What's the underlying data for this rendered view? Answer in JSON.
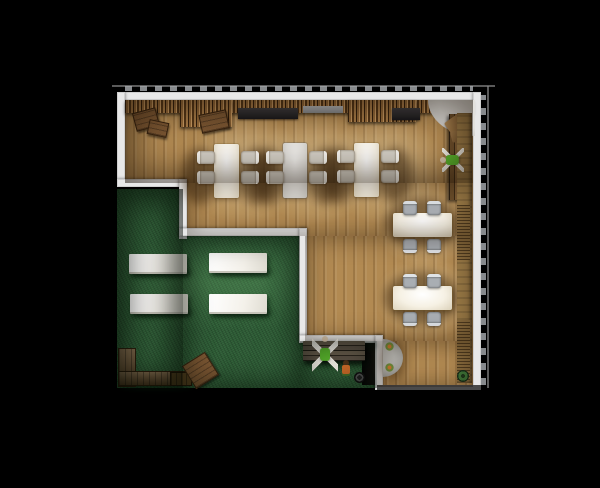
{
  "scene": {
    "title": "cafe-floor-plan-top-down-render",
    "palette": {
      "bg": "#000000",
      "wood": "#b28a52",
      "grass": "#2b5a33",
      "wall": "#e8e8e8",
      "person_green": "#58b32c",
      "table_white": "#f6f1e4",
      "table_gray": "#e1dfda",
      "chair_gray": "#a9aeb3",
      "crate_brown": "#7a5632",
      "slat_brown": "#936939"
    },
    "items": [
      {
        "n": "wood-floor-top",
        "t": "wood",
        "x": 125,
        "y": 100,
        "w": 348,
        "h": 83
      },
      {
        "n": "wood-floor-mid",
        "t": "wood",
        "x": 187,
        "y": 183,
        "w": 286,
        "h": 53
      },
      {
        "n": "wood-floor-right",
        "t": "wood",
        "x": 305,
        "y": 236,
        "w": 168,
        "h": 105
      },
      {
        "n": "wood-floor-bottom",
        "t": "wood",
        "x": 377,
        "y": 341,
        "w": 96,
        "h": 46
      },
      {
        "n": "grass-left",
        "t": "grass",
        "x": 117,
        "y": 189,
        "w": 66,
        "h": 199
      },
      {
        "n": "grass-main",
        "t": "grass",
        "x": 183,
        "y": 236,
        "w": 117,
        "h": 152
      },
      {
        "n": "grass-bottom",
        "t": "grass",
        "x": 300,
        "y": 341,
        "w": 77,
        "h": 47
      },
      {
        "n": "light-pool-1",
        "t": "light",
        "x": 185,
        "y": 113,
        "w": 120,
        "h": 112
      },
      {
        "n": "light-pool-2",
        "t": "light",
        "x": 255,
        "y": 113,
        "w": 120,
        "h": 112
      },
      {
        "n": "light-pool-3",
        "t": "light",
        "x": 325,
        "y": 113,
        "w": 120,
        "h": 112
      },
      {
        "n": "light-pool-4",
        "t": "light",
        "x": 375,
        "y": 183,
        "w": 100,
        "h": 84
      },
      {
        "n": "light-pool-5",
        "t": "light",
        "x": 375,
        "y": 256,
        "w": 100,
        "h": 84
      },
      {
        "n": "grass-light-1",
        "t": "glight",
        "x": 122,
        "y": 233,
        "w": 160,
        "h": 98
      },
      {
        "n": "grass-light-2",
        "t": "glight",
        "x": 190,
        "y": 233,
        "w": 130,
        "h": 98
      },
      {
        "n": "wall-top",
        "t": "wall",
        "x": 117,
        "y": 92,
        "w": 364,
        "h": 8
      },
      {
        "n": "wall-left",
        "t": "wall",
        "x": 117,
        "y": 92,
        "w": 8,
        "h": 90
      },
      {
        "n": "wall-right",
        "t": "wall",
        "x": 473,
        "y": 92,
        "w": 8,
        "h": 298
      },
      {
        "n": "wall-step1-h",
        "t": "wall",
        "x": 117,
        "y": 179,
        "w": 70,
        "h": 8
      },
      {
        "n": "wall-step1-v",
        "t": "wall",
        "x": 179,
        "y": 179,
        "w": 8,
        "h": 60
      },
      {
        "n": "wall-step2-h",
        "t": "wall",
        "x": 179,
        "y": 228,
        "w": 128,
        "h": 8
      },
      {
        "n": "wall-step2-v",
        "t": "wall",
        "x": 299,
        "y": 228,
        "w": 8,
        "h": 110
      },
      {
        "n": "wall-step3-h",
        "t": "wall",
        "x": 299,
        "y": 335,
        "w": 84,
        "h": 8
      },
      {
        "n": "wall-step3-v",
        "t": "wall",
        "x": 375,
        "y": 335,
        "w": 8,
        "h": 55
      },
      {
        "n": "wall-bottom-edge",
        "t": "wall-dim",
        "x": 377,
        "y": 385,
        "w": 104,
        "h": 5
      },
      {
        "n": "doorway-opening",
        "t": "door",
        "x": 362,
        "y": 343,
        "w": 13,
        "h": 42
      },
      {
        "n": "dim-line-top",
        "t": "tickline",
        "x": 112,
        "y": 85,
        "w": 383,
        "h": 2
      },
      {
        "n": "dim-ticks-top",
        "t": "ticks",
        "x": 125,
        "y": 86,
        "w": 348,
        "h": 5
      },
      {
        "n": "dim-line-right",
        "t": "tickline",
        "x": 487,
        "y": 86,
        "w": 2,
        "h": 302
      },
      {
        "n": "dim-ticks-right",
        "t": "ticks-v",
        "x": 481,
        "y": 95,
        "w": 5,
        "h": 290
      },
      {
        "n": "shadow-table1-left",
        "t": "sh",
        "x": 182,
        "y": 148,
        "w": 36,
        "h": 56
      },
      {
        "n": "shadow-table1-right",
        "t": "sh",
        "x": 238,
        "y": 148,
        "w": 36,
        "h": 56
      },
      {
        "n": "shadow-table2-left",
        "t": "sh",
        "x": 252,
        "y": 148,
        "w": 34,
        "h": 56
      },
      {
        "n": "shadow-table2-right",
        "t": "sh",
        "x": 308,
        "y": 148,
        "w": 34,
        "h": 56
      },
      {
        "n": "shadow-table3-left",
        "t": "sh",
        "x": 322,
        "y": 147,
        "w": 34,
        "h": 56
      },
      {
        "n": "shadow-table3-right",
        "t": "sh",
        "x": 378,
        "y": 147,
        "w": 34,
        "h": 56
      },
      {
        "n": "shadow-side-table-1",
        "t": "sh",
        "x": 384,
        "y": 198,
        "w": 76,
        "h": 50
      },
      {
        "n": "shadow-side-table-2",
        "t": "sh",
        "x": 384,
        "y": 272,
        "w": 76,
        "h": 52
      },
      {
        "n": "shadow-semi-table",
        "t": "sh",
        "x": 380,
        "y": 340,
        "w": 26,
        "h": 40
      },
      {
        "n": "shadow-wall-step3",
        "t": "shg",
        "x": 300,
        "y": 342,
        "w": 78,
        "h": 6
      },
      {
        "n": "shadow-grass-bench-1",
        "t": "shg",
        "x": 133,
        "y": 268,
        "w": 58,
        "h": 9
      },
      {
        "n": "shadow-grass-bench-2",
        "t": "shg",
        "x": 213,
        "y": 267,
        "w": 58,
        "h": 9
      },
      {
        "n": "shadow-grass-bench-3",
        "t": "shg",
        "x": 134,
        "y": 308,
        "w": 58,
        "h": 9
      },
      {
        "n": "shadow-grass-bench-4",
        "t": "shg",
        "x": 213,
        "y": 308,
        "w": 58,
        "h": 9
      },
      {
        "n": "shadow-step-bench",
        "t": "shg",
        "x": 303,
        "y": 357,
        "w": 66,
        "h": 10
      },
      {
        "n": "shadow-log-bench",
        "t": "shg",
        "x": 120,
        "y": 380,
        "w": 72,
        "h": 9
      },
      {
        "n": "slat-wall-band",
        "t": "slats",
        "x": 125,
        "y": 100,
        "w": 348,
        "h": 13
      },
      {
        "n": "slat-screen-left",
        "t": "slats",
        "x": 180,
        "y": 100,
        "w": 52,
        "h": 27
      },
      {
        "n": "slat-screen-right",
        "t": "slats",
        "x": 348,
        "y": 100,
        "w": 68,
        "h": 22
      },
      {
        "n": "shelf-dark-left",
        "t": "counter-dark",
        "x": 238,
        "y": 108,
        "w": 60,
        "h": 11
      },
      {
        "n": "shelf-gray",
        "t": "counter-gray",
        "x": 303,
        "y": 106,
        "w": 40,
        "h": 7
      },
      {
        "n": "shelf-dark-right",
        "t": "counter-dark",
        "x": 392,
        "y": 108,
        "w": 28,
        "h": 12
      },
      {
        "n": "crate-stack-1",
        "t": "crate",
        "x": 134,
        "y": 110,
        "w": 22,
        "h": 17,
        "r": -15
      },
      {
        "n": "crate-stack-2",
        "t": "crate",
        "x": 148,
        "y": 121,
        "w": 18,
        "h": 13,
        "r": 12
      },
      {
        "n": "crate-stack-3",
        "t": "crate",
        "x": 200,
        "y": 112,
        "w": 26,
        "h": 17,
        "r": -12
      },
      {
        "n": "corner-rug",
        "t": "rugq",
        "x": 428,
        "y": 100,
        "w": 47,
        "h": 36
      },
      {
        "n": "corner-bench",
        "t": "bench-wood-v",
        "x": 449,
        "y": 114,
        "w": 19,
        "h": 86
      },
      {
        "n": "corner-cushion-1",
        "t": "cushion",
        "x": 446,
        "y": 117,
        "w": 18,
        "h": 13,
        "r": -35
      },
      {
        "n": "corner-cushion-2",
        "t": "cushion2",
        "x": 451,
        "y": 130,
        "w": 16,
        "h": 11,
        "r": -15
      },
      {
        "n": "right-wall-counter",
        "t": "wood-strip",
        "x": 457,
        "y": 113,
        "w": 15,
        "h": 270
      },
      {
        "n": "radiator-upper",
        "t": "radiator",
        "x": 457,
        "y": 205,
        "w": 13,
        "h": 55
      },
      {
        "n": "radiator-lower",
        "t": "radiator",
        "x": 457,
        "y": 320,
        "w": 13,
        "h": 60
      },
      {
        "n": "dining-table-1",
        "t": "table-white",
        "x": 214,
        "y": 144,
        "w": 25,
        "h": 54
      },
      {
        "n": "dining-table-2",
        "t": "table-gray",
        "x": 283,
        "y": 143,
        "w": 24,
        "h": 55
      },
      {
        "n": "dining-table-3",
        "t": "table-white",
        "x": 354,
        "y": 143,
        "w": 25,
        "h": 54
      },
      {
        "n": "chair-t1-left-1",
        "t": "chair cw",
        "x": 197,
        "y": 151,
        "w": 15,
        "h": 13
      },
      {
        "n": "chair-t1-left-2",
        "t": "chair cw",
        "x": 197,
        "y": 171,
        "w": 15,
        "h": 13
      },
      {
        "n": "chair-t1-right-1",
        "t": "chair ce",
        "x": 241,
        "y": 151,
        "w": 15,
        "h": 13
      },
      {
        "n": "chair-t1-right-2",
        "t": "chair ce",
        "x": 241,
        "y": 171,
        "w": 15,
        "h": 13
      },
      {
        "n": "chair-t2-left-1",
        "t": "chair cw",
        "x": 266,
        "y": 151,
        "w": 15,
        "h": 13
      },
      {
        "n": "chair-t2-left-2",
        "t": "chair cw",
        "x": 266,
        "y": 171,
        "w": 15,
        "h": 13
      },
      {
        "n": "chair-t2-right-1",
        "t": "chair ce",
        "x": 309,
        "y": 151,
        "w": 15,
        "h": 13
      },
      {
        "n": "chair-t2-right-2",
        "t": "chair ce",
        "x": 309,
        "y": 171,
        "w": 15,
        "h": 13
      },
      {
        "n": "chair-t3-left-1",
        "t": "chair cw",
        "x": 337,
        "y": 150,
        "w": 15,
        "h": 13
      },
      {
        "n": "chair-t3-left-2",
        "t": "chair cw",
        "x": 337,
        "y": 170,
        "w": 15,
        "h": 13
      },
      {
        "n": "chair-t3-right-1",
        "t": "chair ce",
        "x": 381,
        "y": 150,
        "w": 15,
        "h": 13
      },
      {
        "n": "chair-t3-right-2",
        "t": "chair ce",
        "x": 381,
        "y": 170,
        "w": 15,
        "h": 13
      },
      {
        "n": "side-table-1",
        "t": "table-white",
        "x": 393,
        "y": 213,
        "w": 59,
        "h": 24
      },
      {
        "n": "side-table-2",
        "t": "table-white",
        "x": 393,
        "y": 286,
        "w": 59,
        "h": 24
      },
      {
        "n": "chair-s1-top-1",
        "t": "chair gray cn",
        "x": 403,
        "y": 201,
        "w": 14,
        "h": 11
      },
      {
        "n": "chair-s1-top-2",
        "t": "chair gray cn",
        "x": 427,
        "y": 201,
        "w": 14,
        "h": 11
      },
      {
        "n": "chair-s1-bottom-1",
        "t": "chair gray cs",
        "x": 403,
        "y": 239,
        "w": 14,
        "h": 11
      },
      {
        "n": "chair-s1-bottom-2",
        "t": "chair gray cs",
        "x": 427,
        "y": 239,
        "w": 14,
        "h": 11
      },
      {
        "n": "chair-s2-top-1",
        "t": "chair gray cn",
        "x": 403,
        "y": 274,
        "w": 14,
        "h": 11
      },
      {
        "n": "chair-s2-top-2",
        "t": "chair gray cn",
        "x": 427,
        "y": 274,
        "w": 14,
        "h": 11
      },
      {
        "n": "chair-s2-bottom-1",
        "t": "chair gray cs",
        "x": 403,
        "y": 312,
        "w": 14,
        "h": 11
      },
      {
        "n": "chair-s2-bottom-2",
        "t": "chair gray cs",
        "x": 427,
        "y": 312,
        "w": 14,
        "h": 11
      },
      {
        "n": "grass-bench-1",
        "t": "bench-white",
        "x": 129,
        "y": 254,
        "w": 58,
        "h": 18
      },
      {
        "n": "grass-bench-2",
        "t": "bench-white",
        "x": 209,
        "y": 253,
        "w": 58,
        "h": 18
      },
      {
        "n": "grass-bench-3",
        "t": "bench-white",
        "x": 130,
        "y": 294,
        "w": 58,
        "h": 18
      },
      {
        "n": "grass-bench-4",
        "t": "bench-white",
        "x": 209,
        "y": 294,
        "w": 58,
        "h": 18
      },
      {
        "n": "semi-round-table",
        "t": "semi",
        "x": 383,
        "y": 339,
        "w": 20,
        "h": 38
      },
      {
        "n": "semi-table-plant-1",
        "t": "plant-o",
        "x": 385,
        "y": 342,
        "w": 9,
        "h": 9
      },
      {
        "n": "semi-table-plant-2",
        "t": "plant-o",
        "x": 385,
        "y": 363,
        "w": 9,
        "h": 9
      },
      {
        "n": "floor-pot",
        "t": "pot-dark",
        "x": 354,
        "y": 372,
        "w": 11,
        "h": 11
      },
      {
        "n": "floor-plant",
        "t": "plant-g",
        "x": 457,
        "y": 370,
        "w": 12,
        "h": 12
      },
      {
        "n": "grass-step-bench",
        "t": "bench-wood-h",
        "x": 303,
        "y": 341,
        "w": 62,
        "h": 20
      },
      {
        "n": "log-bench-vertical",
        "t": "wood-rustic",
        "x": 118,
        "y": 348,
        "w": 16,
        "h": 37
      },
      {
        "n": "log-bench-horizontal",
        "t": "wood-rustic",
        "x": 118,
        "y": 371,
        "w": 70,
        "h": 13
      },
      {
        "n": "log-bench-end",
        "t": "wood-rustic-d",
        "x": 170,
        "y": 372,
        "w": 20,
        "h": 12
      },
      {
        "n": "tilted-crate",
        "t": "crate",
        "x": 187,
        "y": 357,
        "w": 25,
        "h": 25,
        "r": -32
      },
      {
        "n": "person-lounging",
        "t": "person",
        "x": 441,
        "y": 149,
        "w": 24,
        "h": 22,
        "r": -90
      },
      {
        "n": "person-sitting",
        "t": "person",
        "x": 312,
        "y": 338,
        "w": 26,
        "h": 34
      },
      {
        "n": "person-child",
        "t": "child",
        "x": 339,
        "y": 360,
        "w": 13,
        "h": 15
      },
      {
        "n": "vignette-wood-top",
        "t": "ovw",
        "x": 125,
        "y": 100,
        "w": 348,
        "h": 83
      },
      {
        "n": "vignette-wood-mid",
        "t": "ovw2",
        "x": 187,
        "y": 183,
        "w": 286,
        "h": 53
      },
      {
        "n": "vignette-wood-right",
        "t": "ovw2",
        "x": 305,
        "y": 236,
        "w": 168,
        "h": 105
      },
      {
        "n": "vignette-wood-bottom",
        "t": "ovw2",
        "x": 377,
        "y": 341,
        "w": 96,
        "h": 46
      },
      {
        "n": "vignette-grass-left",
        "t": "ovg",
        "x": 117,
        "y": 189,
        "w": 66,
        "h": 199
      },
      {
        "n": "vignette-grass-main",
        "t": "ovg2",
        "x": 183,
        "y": 236,
        "w": 117,
        "h": 152
      },
      {
        "n": "vignette-grass-bottom",
        "t": "ovg2",
        "x": 300,
        "y": 341,
        "w": 77,
        "h": 47
      }
    ]
  }
}
